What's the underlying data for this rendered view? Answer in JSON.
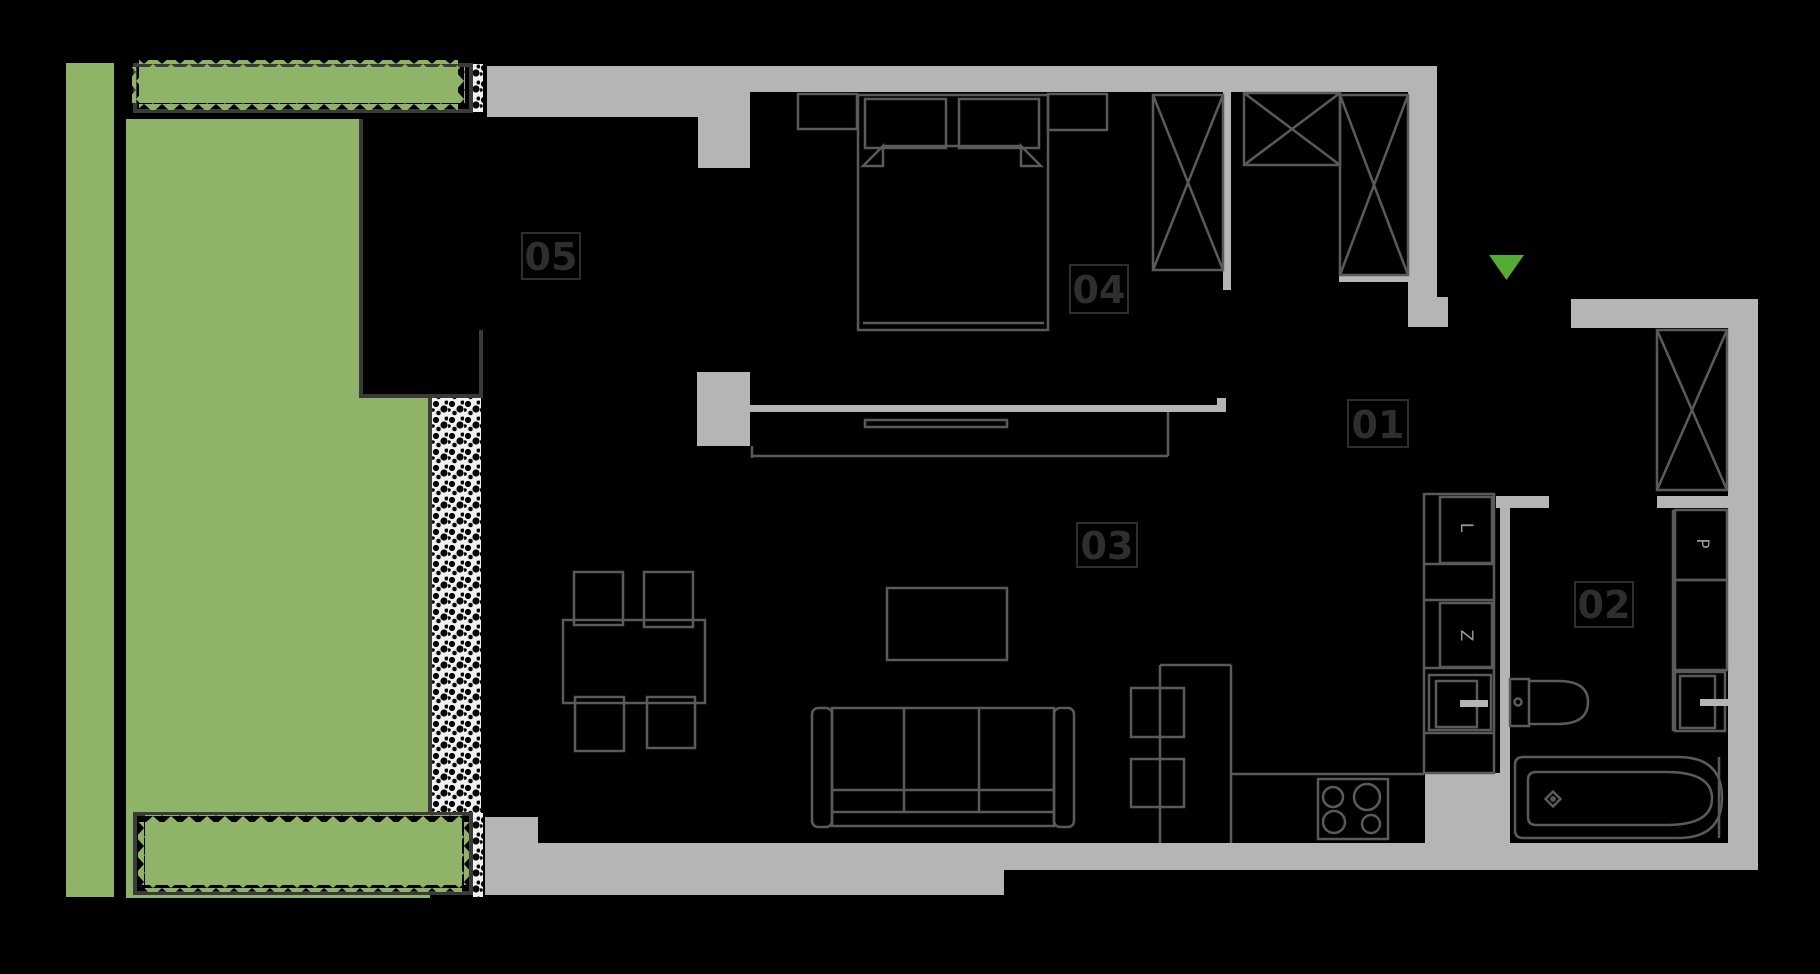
{
  "plan": {
    "rooms": [
      {
        "label": "05"
      },
      {
        "label": "04"
      },
      {
        "label": "03"
      },
      {
        "label": "01"
      },
      {
        "label": "02"
      }
    ],
    "cabinet_letters": {
      "kitchen_upper": "L",
      "kitchen_lower": "Z",
      "bathroom": "P"
    },
    "entrance_marker": "▼"
  },
  "colors": {
    "background": "#000000",
    "wall_gray": "#b5b5b5",
    "garden_green": "#8fb468",
    "entrance_arrow_green": "#54ad30",
    "furniture_line": "#5a5a5a",
    "dark_frame": "#3a3a3a",
    "room_label": "#2e2e2e",
    "cabinet_letter": "#9a9a9a",
    "gravel_hatch_bg": "#f2f2f2"
  }
}
